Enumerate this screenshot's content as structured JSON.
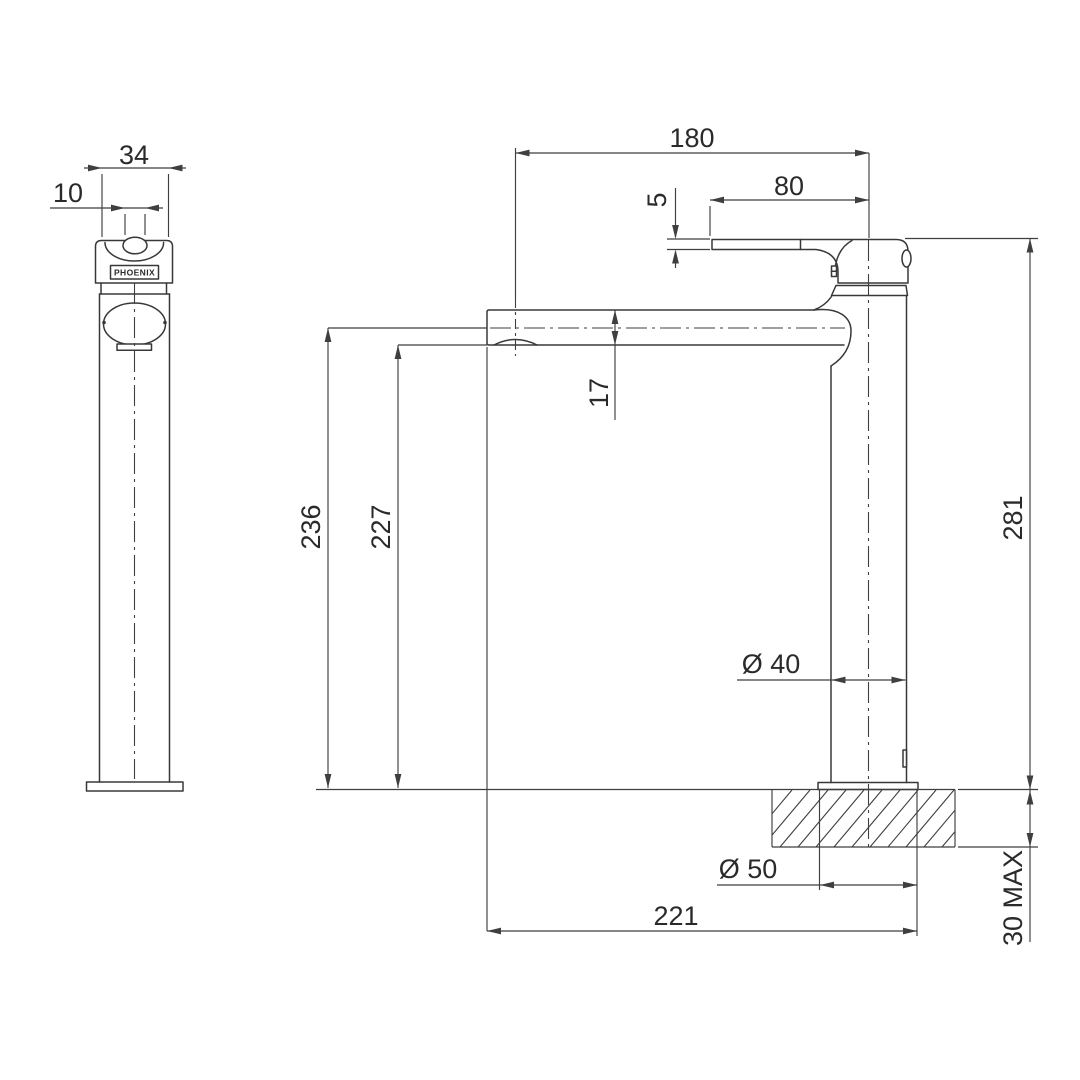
{
  "colors": {
    "background": "#ffffff",
    "line": "#3f3f3f",
    "text": "#2a2a2a"
  },
  "front_view": {
    "brand_label": "PHOENIX",
    "dims": {
      "body_width": "34",
      "spout_tip_width": "10"
    }
  },
  "side_view": {
    "dims": {
      "spout_reach": "180",
      "handle_length": "80",
      "handle_thickness": "5",
      "spout_depth": "17",
      "height_to_spout_centre": "236",
      "height_to_spout_underside": "227",
      "overall_height": "281",
      "body_diameter": "Ø 40",
      "base_diameter": "Ø 50",
      "overall_depth": "221",
      "max_bench_thickness": "30 MAX"
    }
  }
}
